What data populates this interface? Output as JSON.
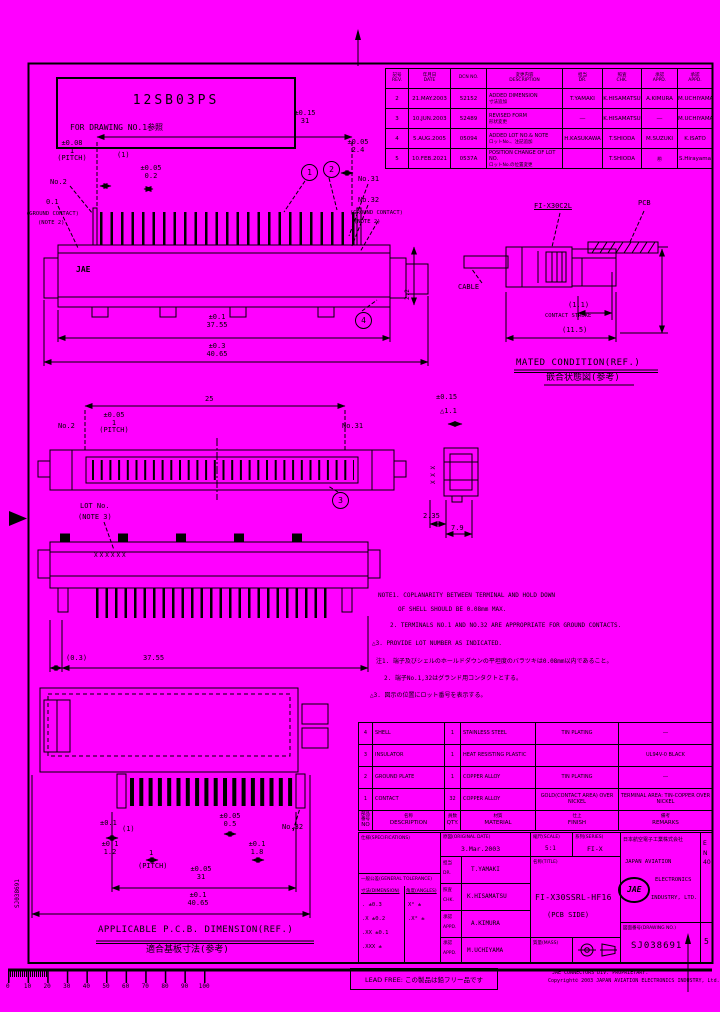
{
  "colors": {
    "background": "#FF00FF",
    "ink": "#000000"
  },
  "stamp": {
    "line1": "12SB03PS",
    "line2": "FOR DRAWING NO.1参照"
  },
  "revision_table": {
    "headers": [
      {
        "jp": "記号",
        "en": "REV."
      },
      {
        "jp": "年月日",
        "en": "DATE"
      },
      {
        "jp": "",
        "en": "DCN NO."
      },
      {
        "jp": "変更内容",
        "en": "DESCRIPTION"
      },
      {
        "jp": "担当",
        "en": "DR."
      },
      {
        "jp": "照査",
        "en": "CHK."
      },
      {
        "jp": "承認",
        "en": "APPD."
      },
      {
        "jp": "承認",
        "en": "APPD."
      }
    ],
    "rows": [
      {
        "rev": "2",
        "date": "21.MAY.2003",
        "dcn": "52152",
        "desc_en": "ADDED DIMENSION",
        "desc_jp": "寸法追加",
        "dr": "T.YAMAKI",
        "chk": "K.HISAMATSU",
        "appd1": "A.KIMURA",
        "appd2": "M.UCHIYAMA"
      },
      {
        "rev": "3",
        "date": "10.JUN.2003",
        "dcn": "52489",
        "desc_en": "REVISED FORM",
        "desc_jp": "形状変更",
        "dr": "―",
        "chk": "K.HISAMATSU",
        "appd1": "―",
        "appd2": "M.UCHIYAMA"
      },
      {
        "rev": "4",
        "date": "5.AUG.2005",
        "dcn": "05094",
        "desc_en": "ADDED LOT NO.& NOTE",
        "desc_jp": "ロットNo.、注記追加",
        "dr": "H.KASUKAWA",
        "chk": "T.SHIODA",
        "appd1": "M.SUZUKI",
        "appd2": "K.ISATO"
      },
      {
        "rev": "5",
        "date": "10.FEB.2021",
        "dcn": "0537A",
        "desc_en": "POSITION CHANGE OF LOT NO.",
        "desc_jp": "ロットNo.の位置変更",
        "dr": "",
        "chk": "T.SHIODA",
        "appd1": "㊞",
        "appd2": "S.Hirayama"
      }
    ]
  },
  "top_view": {
    "dim31_tol": "±0.15",
    "dim31": "31",
    "pitch_tol": "±0.08",
    "pitch_val": "1",
    "pitch_label": "(PITCH)",
    "ref1": "(1)",
    "dim02_tol": "±0.05",
    "dim02": "0.2",
    "no2": "No.2",
    "gl_dim": "0.1",
    "gl_1": "(GROUND CONTACT)",
    "gl_2": "(NOTE 2)",
    "dim24_tol": "±0.05",
    "dim24": "2.4",
    "no31": "No.31",
    "no32": "No.32",
    "gr_1": "(GROUND CONTACT)",
    "gr_2": "(NOTE 2)",
    "jae_mark": "JAE",
    "balloon1": "1",
    "balloon2": "2",
    "balloon4": "4",
    "dim3755_tol": "±0.1",
    "dim3755": "37.55",
    "dim4065_tol": "±0.3",
    "dim4065": "40.65",
    "side_dim": "2.2"
  },
  "mated_view": {
    "plug": "FI-X30C2L",
    "pcb": "PCB",
    "cable": "CABLE",
    "stroke_val": "(1.1)",
    "stroke_label": "CONTACT STROKE",
    "depth": "(11.5)",
    "title": "MATED CONDITION(REF.)",
    "title_jp": "嵌合状態図(参考)"
  },
  "front_view": {
    "dim25": "25",
    "pitch_tol": "±0.05",
    "pitch_val": "1",
    "pitch_label": "(PITCH)",
    "no2": "No.2",
    "no31": "No.31",
    "balloon3": "3",
    "side_tol": "±0.15",
    "side_flag": "△1.1",
    "xmarks": "X X X",
    "dim235": "2.35",
    "dim79": "7.9"
  },
  "side_view2": {
    "lot1": "LOT No.",
    "lot2": "(NOTE 3)",
    "xrow": "XXXXXX",
    "dim03": "(0.3)",
    "dim3755": "37.55"
  },
  "pcb_view": {
    "d1_tol": "±0.1",
    "d1": "(1)",
    "d2_tol": "±0.1",
    "d2": "1.2",
    "d3": "1",
    "d3_label": "(PITCH)",
    "d4_tol": "±0.05",
    "d4": "0.5",
    "d5_tol": "±0.1",
    "d5": "1.8",
    "no32": "No.32",
    "d6_tol": "±0.05",
    "d6": "31",
    "d7_tol": "±0.1",
    "d7": "40.65",
    "title": "APPLICABLE P.C.B. DIMENSION(REF.)",
    "title_jp": "適合基板寸法(参考)"
  },
  "notes": {
    "n1a": "NOTE1. COPLANARITY BETWEEN TERMINAL AND HOLD DOWN",
    "n1b": "OF SHELL SHOULD BE 0.08mm MAX.",
    "n2": "2. TERMINALS NO.1 AND NO.32 ARE APPROPRIATE FOR GROUND CONTACTS.",
    "n3": "△3. PROVIDE LOT NUMBER AS INDICATED.",
    "j1": "注1. 端子及びシェルのホールドダウンの平坦度のバラツキは0.08mm以内であること。",
    "j2": "2. 端子No.1,32はグランド用コンタクトとする。",
    "j3": "△3. 図示の位置にロット番号を表示する。"
  },
  "parts_table": {
    "headers": {
      "no_jp": "部品番号",
      "no_en": "NO",
      "desc_jp": "名称",
      "desc_en": "DESCRIPTION",
      "qty_jp": "員数",
      "qty_en": "QTY.",
      "mat_jp": "材質",
      "mat_en": "MATERIAL",
      "fin_jp": "仕上",
      "fin_en": "FINISH",
      "rem_jp": "備考",
      "rem_en": "REMARKS"
    },
    "rows": [
      {
        "no": "4",
        "desc": "SHELL",
        "qty": "1",
        "material": "STAINLESS STEEL",
        "finish": "TIN PLATING",
        "remarks": "―"
      },
      {
        "no": "3",
        "desc": "INSULATOR",
        "qty": "1",
        "material": "HEAT RESISTING PLASTIC",
        "finish": "",
        "remarks": "UL94V-0 BLACK"
      },
      {
        "no": "2",
        "desc": "GROUND PLATE",
        "qty": "1",
        "material": "COPPER ALLOY",
        "finish": "TIN PLATING",
        "remarks": "―"
      },
      {
        "no": "1",
        "desc": "CONTACT",
        "qty": "32",
        "material": "COPPER ALLOY",
        "finish": "GOLD(CONTACT AREA) OVER NICKEL",
        "remarks": "TERMINAL AREA: TIN-COPPER OVER NICKEL"
      }
    ]
  },
  "title_block": {
    "spec_label": "仕様(SPECIFICATIONS)",
    "tol_label": "一般公差(GENERAL TOLERANCE)",
    "dim_col": "寸法(DIMENSION)",
    "ang_col": "角度(ANGLES)",
    "tol_d1": ".    ±0.3",
    "tol_d2": ".X   ±0.2",
    "tol_d3": ".XX  ±0.1",
    "tol_d4": ".XXX ±",
    "tol_a1": "X°  ±",
    "tol_a2": ".X° ±",
    "orig_label": "原図(ORIGINAL DATE)",
    "orig_date": "3.Mar.2003",
    "dr_jp": "担当",
    "dr_en": "DR.",
    "dr": "T.YAMAKI",
    "chk_jp": "照査",
    "chk_en": "CHK.",
    "chk": "K.HISAMATSU",
    "appd_jp": "承認",
    "appd_en": "APPD.",
    "appd1": "A.KIMURA",
    "appd2": "M.UCHIYAMA",
    "scale_label": "縮尺(SCALE)",
    "scale": "5:1",
    "series_label": "系列(SERIES)",
    "series": "FI-X",
    "title_label": "名称(TITLE)",
    "part_number": "FI-X30SSRL-HF16",
    "part_suffix": "(PCB SIDE)",
    "mass_label": "質量(MASS)",
    "company_jp": "日本航空電子工業株式会社",
    "company_en1": "JAPAN AVIATION",
    "company_en2": "ELECTRONICS",
    "company_en3": "INDUSTRY, LTD.",
    "logo": "JAE",
    "dwg_label": "図面番号(DRAWING NO.)",
    "dwg_no": "SJ038691",
    "rev": "5",
    "form_code": "EN40"
  },
  "footer": {
    "lead_free": "LEAD FREE: この製品は鉛フリー品です",
    "copyright1": "JAE CONNECTORS DIV. PROPRIETARY.",
    "copyright2": "Copyright© 2003 JAPAN AVIATION ELECTRONICS INDUSTRY, Ltd.",
    "side_no": "SJ038691"
  },
  "ruler": {
    "labels": [
      {
        "t": "0"
      },
      {
        "t": "10"
      },
      {
        "t": "20"
      },
      {
        "t": "30"
      },
      {
        "t": "40"
      },
      {
        "t": "50"
      },
      {
        "t": "60"
      },
      {
        "t": "70"
      },
      {
        "t": "80"
      },
      {
        "t": "90"
      },
      {
        "t": "100"
      }
    ]
  }
}
